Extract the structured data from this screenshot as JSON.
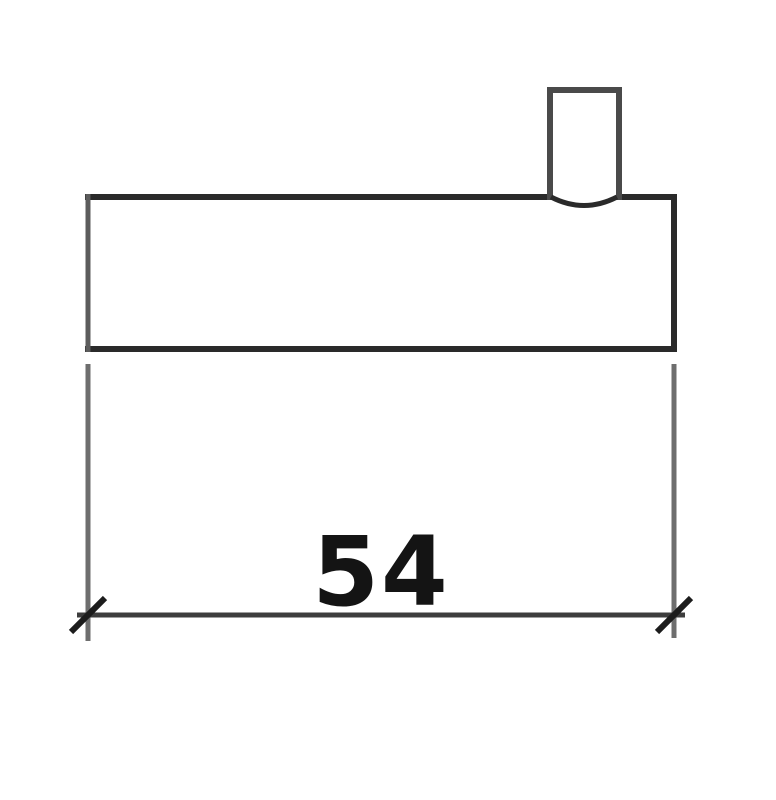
{
  "drawing": {
    "type": "technical-dimension-drawing",
    "dimension": {
      "label": "54"
    },
    "colors": {
      "background": "#ffffff",
      "outline": "#2a2a2a",
      "stub": "#4a4a4a",
      "left_edge": "#5c5c5c",
      "extension": "#6e6e6e",
      "dimension_line": "#3d3d3d",
      "tick": "#1c1c1c",
      "text": "#141414"
    }
  }
}
